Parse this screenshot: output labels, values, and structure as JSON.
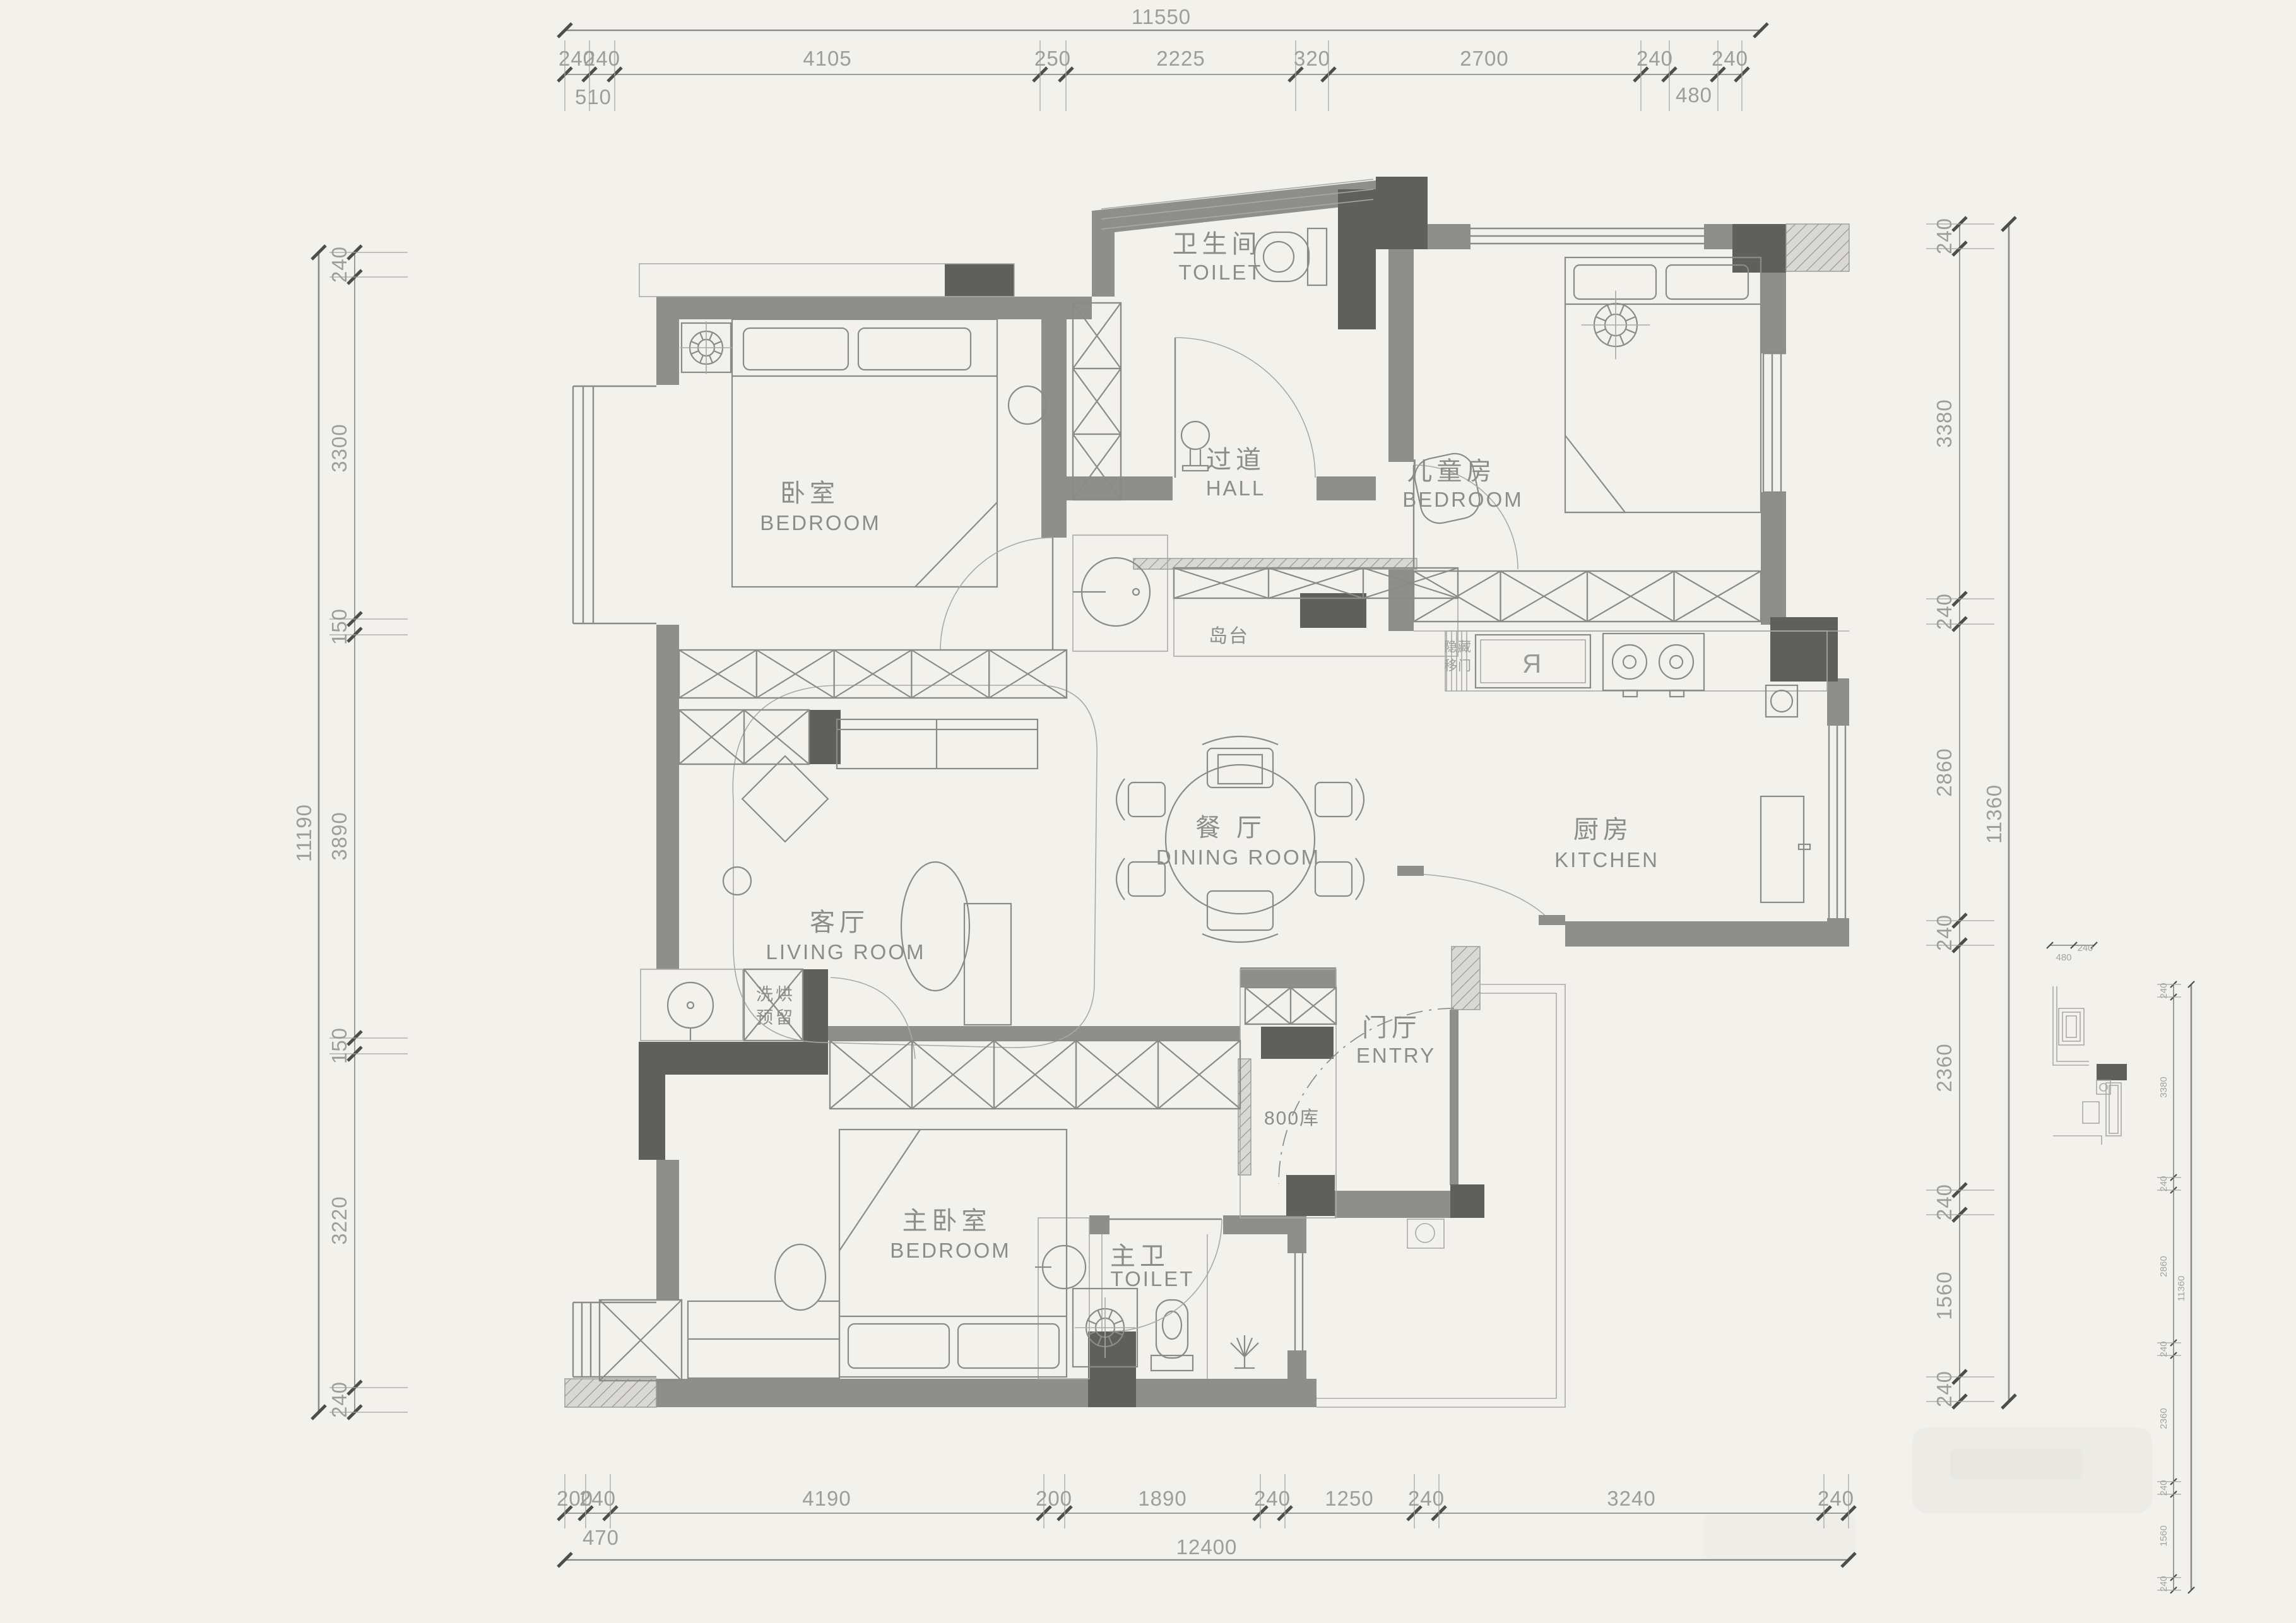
{
  "colors": {
    "paper": "#f2f1ec",
    "wall": "#8e8e8c",
    "wall_dark": "#5f5f5d",
    "line": "#8a8a88",
    "line_light": "#a9a9a6",
    "room_text": "#8c8c8a",
    "dim_text": "#9d9d9a"
  },
  "rooms": [
    {
      "id": "bedroom-top-left",
      "zh": "卧室",
      "en": "BEDROOM"
    },
    {
      "id": "toilet-top",
      "zh": "卫生间",
      "en": "TOILET"
    },
    {
      "id": "hall",
      "zh": "过道",
      "en": "HALL"
    },
    {
      "id": "kids-bedroom",
      "zh": "儿童房",
      "en": "BEDROOM"
    },
    {
      "id": "living-room",
      "zh": "客厅",
      "en": "LIVING  ROOM"
    },
    {
      "id": "dining-room",
      "zh": "餐  厅",
      "en": "DINING  ROOM"
    },
    {
      "id": "kitchen",
      "zh": "厨房",
      "en": "KITCHEN"
    },
    {
      "id": "entry",
      "zh": "门厅",
      "en": "ENTRY"
    },
    {
      "id": "master-bedroom",
      "zh": "主卧室",
      "en": "BEDROOM"
    },
    {
      "id": "master-toilet",
      "zh": "主卫",
      "en": "TOILET"
    }
  ],
  "annotations": {
    "island": "岛台",
    "storage": "800库",
    "laundry": [
      "洗烘",
      "预留"
    ],
    "hidden_door": [
      "隐藏",
      "移门"
    ],
    "fridge_glyph": "Я"
  },
  "dimensions": {
    "top": {
      "overall": "11550",
      "segments": [
        "240",
        "240",
        "4105",
        "250",
        "2225",
        "320",
        "2700",
        "240",
        "240"
      ],
      "subs": [
        "510",
        "480"
      ]
    },
    "bottom": {
      "overall": "12400",
      "segments": [
        "200",
        "240",
        "4190",
        "200",
        "1890",
        "240",
        "1250",
        "240",
        "3240",
        "240"
      ],
      "subs": [
        "470"
      ]
    },
    "left": {
      "overall": "11190",
      "segments": [
        "240",
        "3300",
        "150",
        "3890",
        "150",
        "3220",
        "240"
      ]
    },
    "right": {
      "overall": "11360",
      "segments": [
        "240",
        "3380",
        "240",
        "2860",
        "240",
        "2360",
        "240",
        "1560",
        "240"
      ]
    },
    "mini_right": {
      "overall": "11360",
      "segments": [
        "240",
        "3380",
        "240",
        "2860",
        "240",
        "2360",
        "240",
        "1560",
        "240"
      ],
      "subs": [
        "480",
        "240"
      ]
    }
  }
}
